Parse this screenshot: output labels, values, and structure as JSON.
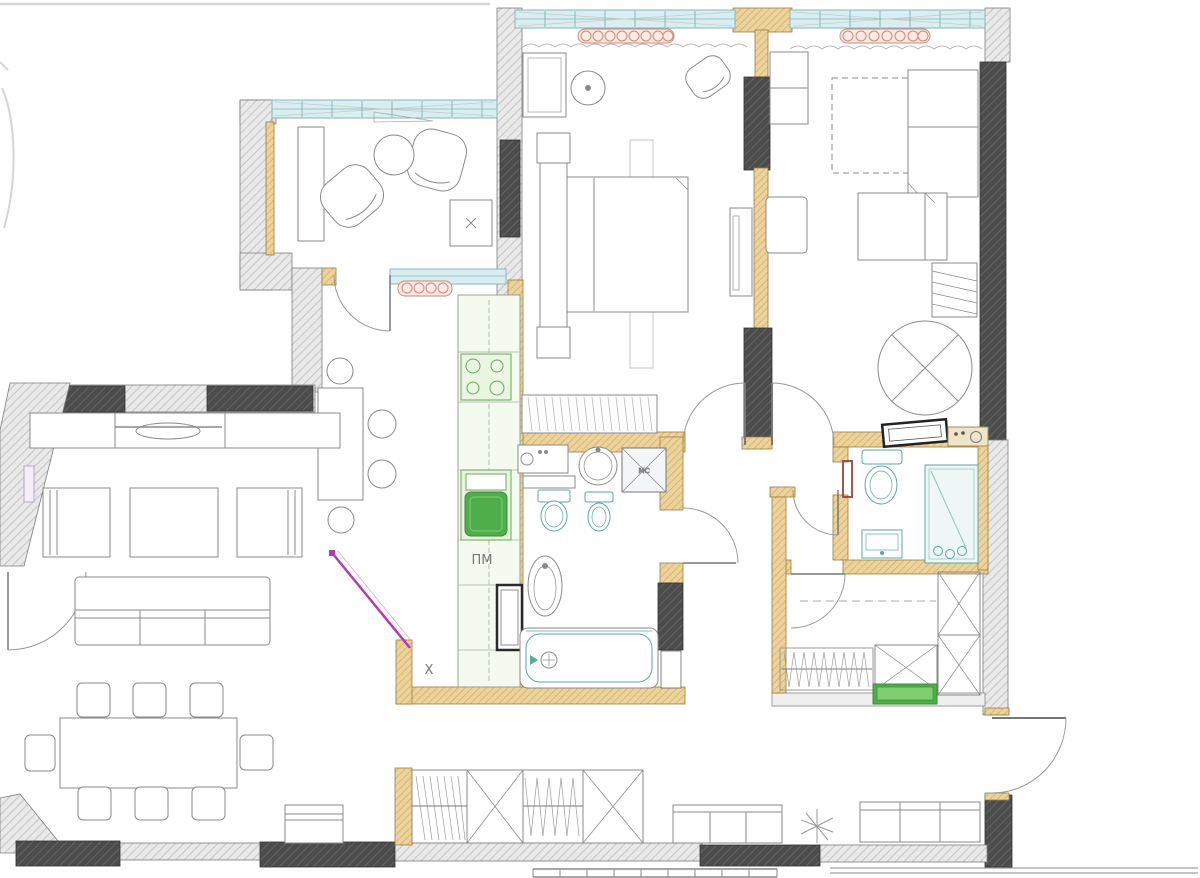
{
  "document": {
    "kind": "apartment floor plan drawing"
  },
  "labels": {
    "dishwasher": "ПМ",
    "kitchen_mark": "X",
    "shaft": "MC"
  },
  "palette": {
    "background": "#ffffff",
    "wall_light_fill": "#e9e9e9",
    "wall_light_hatch": "#bcbcbc",
    "wall_dark_fill": "#4c4c4c",
    "wall_dark_hatch": "#6f6f6f",
    "wall_wood_fill": "#ecd29b",
    "wall_wood_hatch": "#c9a35c",
    "window_glass": "#d8eef0",
    "window_frame": "#86b6ba",
    "fixture_teal": "#5aa7a0",
    "appliance_green": "#4fae4a",
    "appliance_green_light": "#eaf5e2",
    "sliding_door_magenta": "#b43ab4",
    "ensuite_door_red": "#a04040",
    "radiator_pink": "#cc8877",
    "furniture_line": "#8a8a8a",
    "label_text": "#777777"
  },
  "rooms": [
    {
      "name": "loggia"
    },
    {
      "name": "master-bedroom"
    },
    {
      "name": "kids-bedroom"
    },
    {
      "name": "kitchen"
    },
    {
      "name": "living-dining-room"
    },
    {
      "name": "main-bathroom"
    },
    {
      "name": "ensuite-bathroom"
    },
    {
      "name": "walk-in-wardrobe"
    },
    {
      "name": "hallway"
    },
    {
      "name": "entry-hall"
    }
  ]
}
